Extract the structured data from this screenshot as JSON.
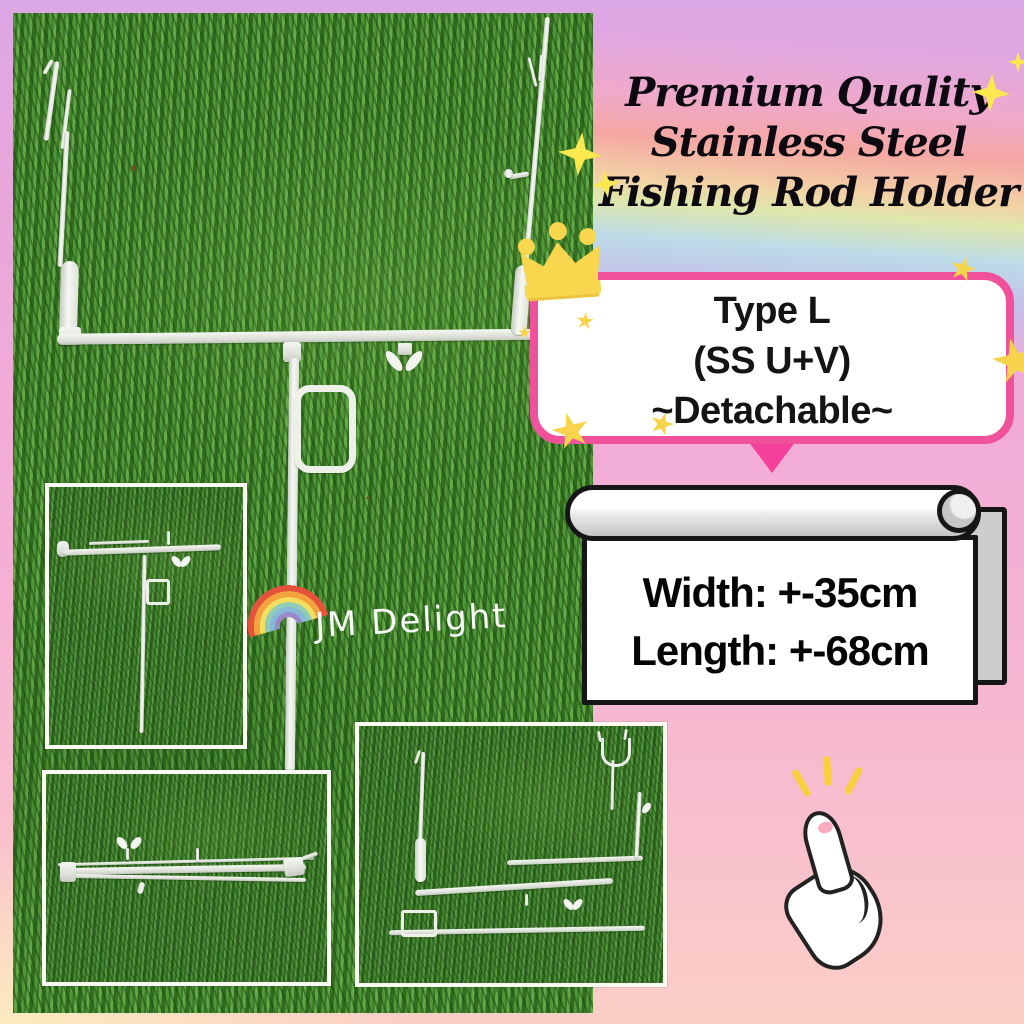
{
  "title": {
    "line1": "Premium Quality",
    "line2": "Stainless Steel",
    "line3": "Fishing Rod Holder"
  },
  "type_box": {
    "line1": "Type L",
    "line2": "(SS U+V)",
    "line3": "~Detachable~"
  },
  "dimensions": {
    "width_label": "Width: +-35cm",
    "length_label": "Length: +-68cm"
  },
  "watermark": {
    "text": "JM Delight"
  },
  "icons": {
    "crown": "crown-icon",
    "sparkle": "sparkle-icon",
    "star": "star-icon",
    "rainbow": "rainbow-icon",
    "thumbs_up": "thumbs-up-icon",
    "scroll_banner": "paper-scroll-banner"
  },
  "colors": {
    "accent_pink_border": "#f0519b",
    "accent_pink_tail": "#f4409a",
    "crown_gold": "#f8d64e",
    "star_yellow": "#f8d44c",
    "grass_green": "#47862f",
    "background_top_purple": "#dca7e5",
    "background_bottom_cream": "#fdeebe",
    "banner_outline": "#161616"
  }
}
